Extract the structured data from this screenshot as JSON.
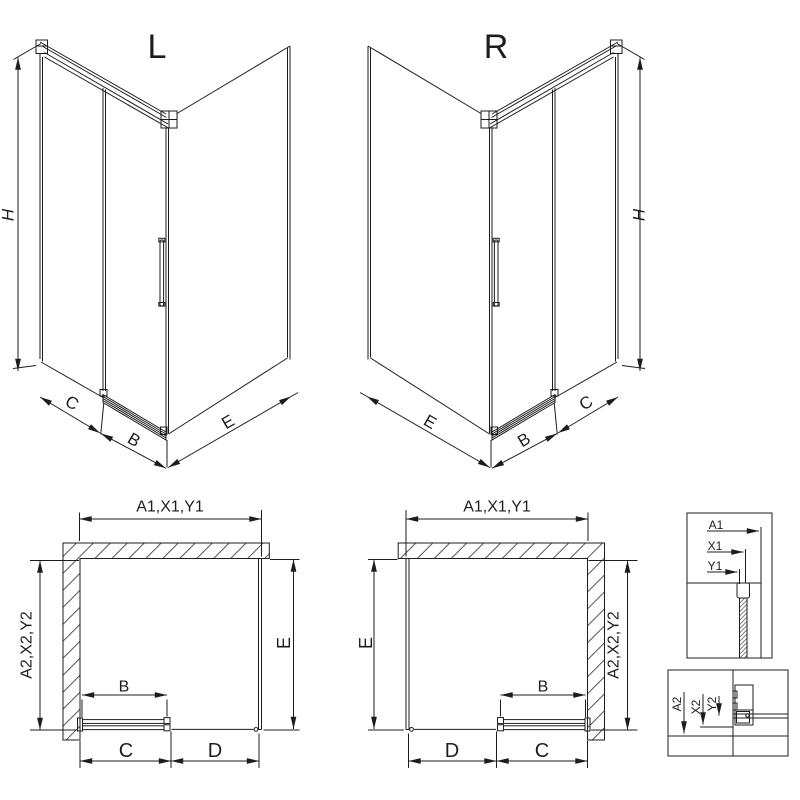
{
  "diagram": {
    "iso_left": {
      "label": "L",
      "dims": {
        "h": "H",
        "c": "C",
        "b": "B",
        "e": "E"
      }
    },
    "iso_right": {
      "label": "R",
      "dims": {
        "h": "H",
        "c": "C",
        "b": "B",
        "e": "E"
      }
    },
    "plan_left": {
      "dims": {
        "top": "A1,X1,Y1",
        "side": "A2,X2,Y2",
        "e": "E",
        "b": "B",
        "c": "C",
        "d": "D"
      }
    },
    "plan_right": {
      "dims": {
        "top": "A1,X1,Y1",
        "side": "A2,X2,Y2",
        "e": "E",
        "b": "B",
        "c": "C",
        "d": "D"
      }
    },
    "detail_top": {
      "labels": {
        "a": "A1",
        "x": "X1",
        "y": "Y1"
      }
    },
    "detail_bottom": {
      "labels": {
        "a": "A2",
        "x": "X2",
        "y": "Y2"
      }
    },
    "colors": {
      "line": "#1d1d1d",
      "background": "#ffffff"
    }
  }
}
